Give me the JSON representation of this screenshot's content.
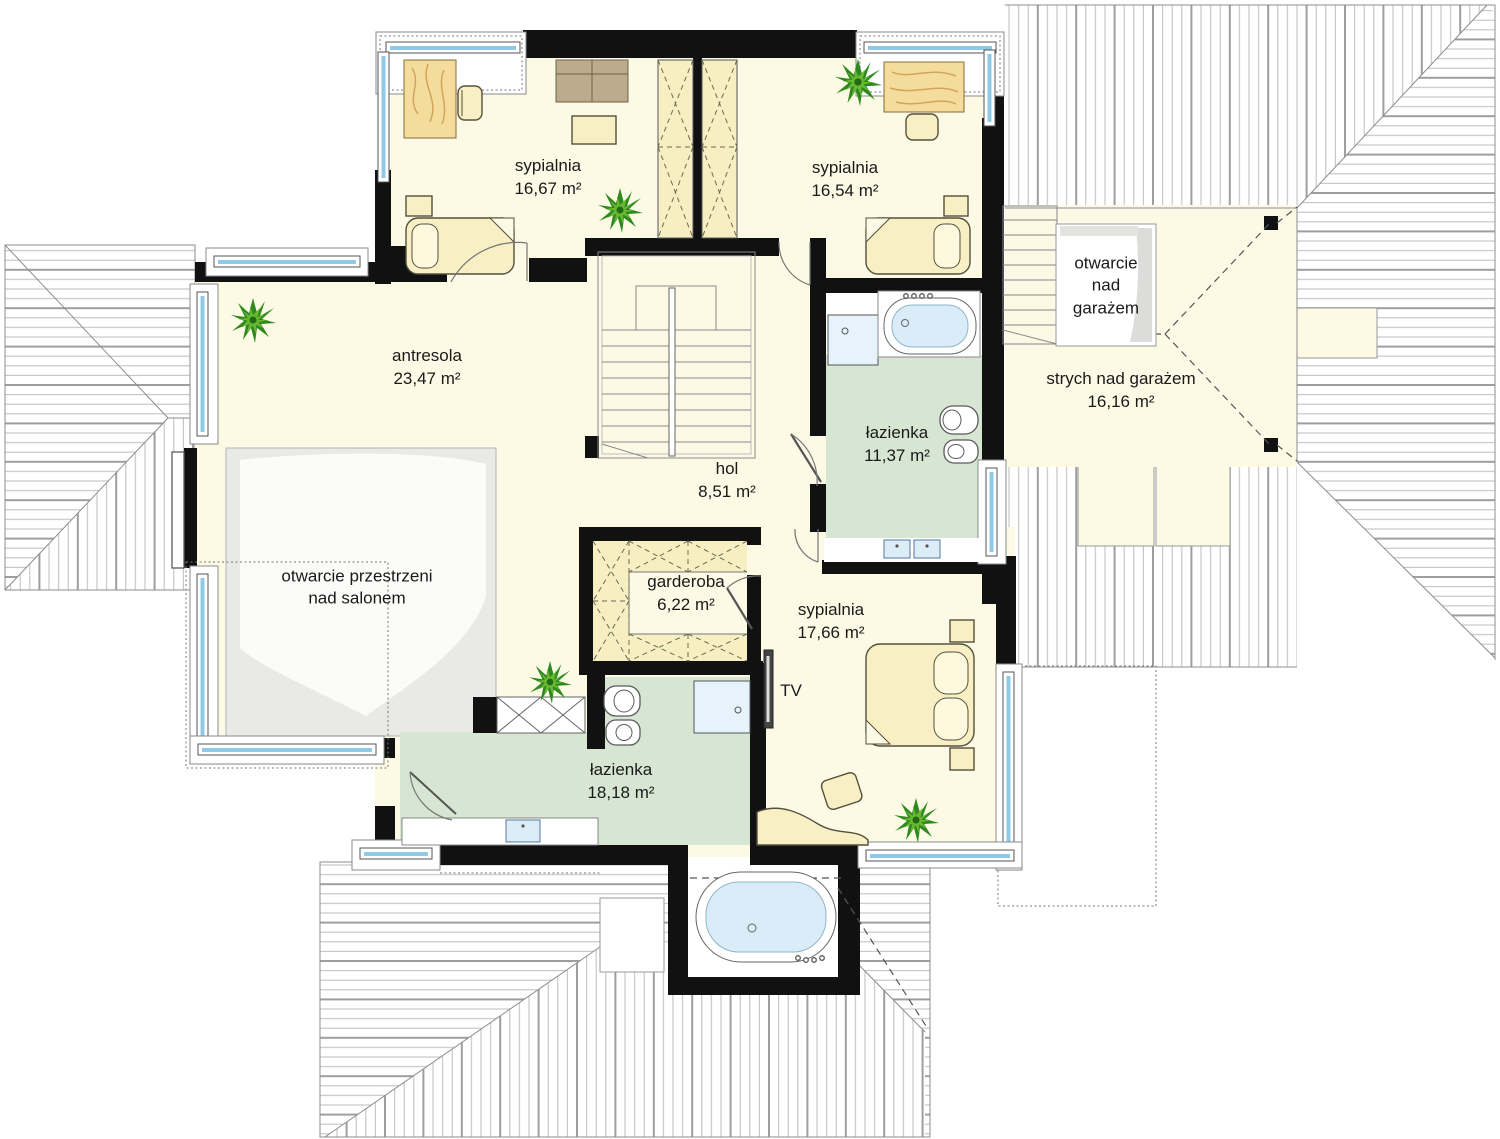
{
  "title": "floor-plan-upper-storey",
  "rooms": [
    {
      "name": "sypialnia",
      "area": "16,67 m²"
    },
    {
      "name": "sypialnia",
      "area": "16,54 m²"
    },
    {
      "name": "antresola",
      "area": "23,47 m²"
    },
    {
      "name": "hol",
      "area": "8,51 m²"
    },
    {
      "name": "łazienka",
      "area": "11,37 m²"
    },
    {
      "name": "strych nad garażem",
      "area": "16,16 m²"
    },
    {
      "name": "garderoba",
      "area": "6,22 m²"
    },
    {
      "name": "sypialnia",
      "area": "17,66 m²"
    },
    {
      "name": "łazienka",
      "area": "18,18 m²"
    }
  ],
  "labels": {
    "opening_over_garage": "otwarcie\nnad\ngarażem",
    "opening_over_living_room": "otwarcie przestrzeni\nnad salonem",
    "tv": "TV"
  },
  "colors": {
    "walls": "#111111",
    "floor": "#fcf9e5",
    "bathroom_floor": "#d7e5d3",
    "closet_fill": "#f7efc2",
    "window_glass": "#8fc9e6",
    "roof_hatch": "#b5b5b5",
    "void_gray": "#e9e9e6",
    "plant_green": "#2e8a1e",
    "wood": "#f3dc9c"
  }
}
